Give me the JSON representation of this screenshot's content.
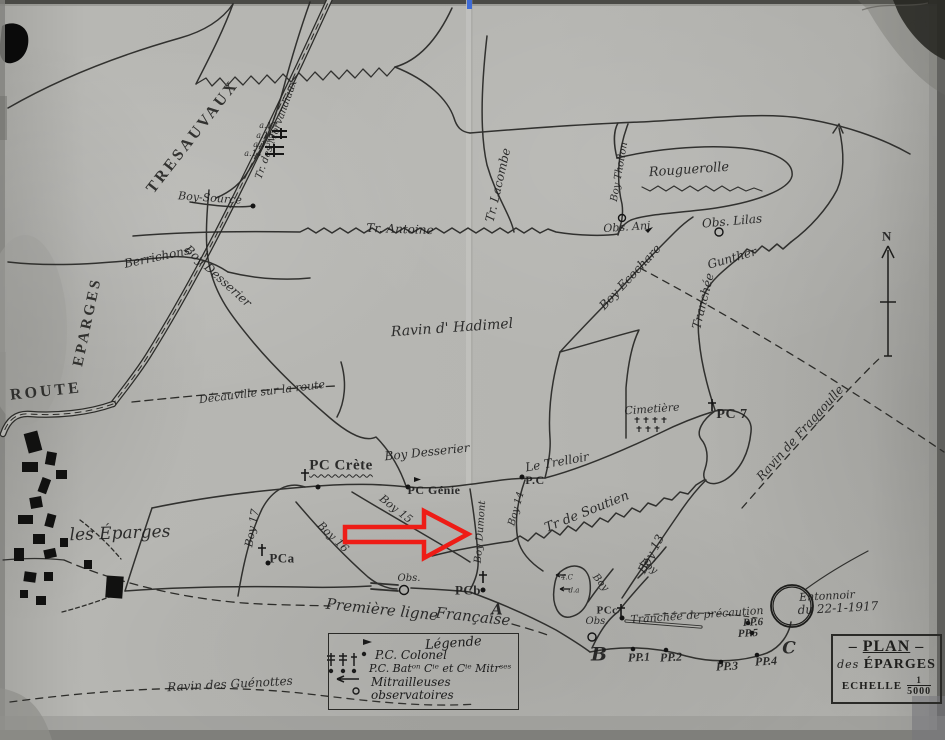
{
  "page": {
    "paper_color": "#b5b5b1",
    "ink_color": "#262624",
    "page_number": "27"
  },
  "annotation": {
    "type": "arrow",
    "color": "#ee1c16"
  },
  "north": {
    "label": "N"
  },
  "title_box": {
    "dash": "–",
    "line1": "PLAN",
    "prefix": "des",
    "line2": "ÉPARGES",
    "scale_label": "ECHELLE",
    "scale_num": "1",
    "scale_den": "5000"
  },
  "legend": {
    "title": "Légende",
    "items": [
      {
        "symbol": "flag-dot",
        "label": "P.C. Colonel"
      },
      {
        "symbol": "cross-dots",
        "label": "P.C. Batᵒⁿ Cⁱᵉ et Cⁱᵉ Mitrˢᵉˢ"
      },
      {
        "symbol": "arrow-left",
        "label": "Mitrailleuses"
      },
      {
        "symbol": "small-circle",
        "label": "observatoires"
      }
    ]
  },
  "crater": {
    "line1": "Entonnoir",
    "line2": "du 22-1-1917"
  },
  "map_labels": [
    {
      "t": "TRESAUVAUX",
      "x": 193,
      "y": 137,
      "r": -52,
      "s": 16,
      "c": "caps",
      "n": "label-tresauvaux"
    },
    {
      "t": "EPARGES",
      "x": 88,
      "y": 322,
      "r": -78,
      "s": 15,
      "c": "caps",
      "n": "label-eparges-road"
    },
    {
      "t": "ROUTE",
      "x": 46,
      "y": 392,
      "r": -6,
      "s": 16,
      "c": "caps",
      "n": "label-route"
    },
    {
      "t": "Berrichons",
      "x": 157,
      "y": 257,
      "r": -12,
      "s": 12,
      "n": "label-berrichons"
    },
    {
      "t": "Boy Desserier",
      "x": 218,
      "y": 276,
      "r": 42,
      "s": 12,
      "n": "label-boy-desserier-nw"
    },
    {
      "t": "Boy-Source",
      "x": 210,
      "y": 198,
      "r": 4,
      "s": 11,
      "n": "label-boy-source"
    },
    {
      "t": "Tr. des Morvandiaux",
      "x": 277,
      "y": 130,
      "r": -70,
      "s": 10,
      "n": "label-tr-morvandiaux"
    },
    {
      "t": "a.17",
      "x": 268,
      "y": 126,
      "r": 0,
      "s": 8,
      "n": "label-a17"
    },
    {
      "t": "a.16",
      "x": 265,
      "y": 136,
      "r": 0,
      "s": 8,
      "n": "label-a16"
    },
    {
      "t": "a.15",
      "x": 262,
      "y": 145,
      "r": 0,
      "s": 8,
      "n": "label-a15"
    },
    {
      "t": "a.14",
      "x": 253,
      "y": 154,
      "r": 0,
      "s": 8,
      "n": "label-a14"
    },
    {
      "t": "Tr. Antoine",
      "x": 400,
      "y": 229,
      "r": 2,
      "s": 12,
      "n": "label-tr-antoine"
    },
    {
      "t": "Tr. Lacombe",
      "x": 498,
      "y": 185,
      "r": -77,
      "s": 12,
      "n": "label-tr-lacombe"
    },
    {
      "t": "Boy Thollon",
      "x": 620,
      "y": 172,
      "r": -80,
      "s": 10,
      "n": "label-boy-thollon"
    },
    {
      "t": "Rouguerolle",
      "x": 689,
      "y": 170,
      "r": -4,
      "s": 13,
      "n": "label-rouguerolle"
    },
    {
      "t": "Obs. Ani",
      "x": 627,
      "y": 227,
      "r": -4,
      "s": 11,
      "n": "label-obs-ani"
    },
    {
      "t": "Obs. Lilas",
      "x": 732,
      "y": 221,
      "r": -5,
      "s": 12,
      "n": "label-obs-lilas"
    },
    {
      "t": "Boy Ecochare",
      "x": 630,
      "y": 277,
      "r": -47,
      "s": 12,
      "n": "label-boy-ecochare"
    },
    {
      "t": "Gunther",
      "x": 732,
      "y": 258,
      "r": -16,
      "s": 12,
      "n": "label-gunther"
    },
    {
      "t": "Tranchée",
      "x": 703,
      "y": 301,
      "r": -76,
      "s": 12,
      "n": "label-tranchee-gunther"
    },
    {
      "t": "Ravin   d' Hadimel",
      "x": 452,
      "y": 328,
      "r": -4,
      "s": 14,
      "n": "label-ravin-hadimel"
    },
    {
      "t": "Décauville sur la route",
      "x": 262,
      "y": 392,
      "r": -7,
      "s": 11,
      "n": "label-decauville"
    },
    {
      "t": "Cimetière",
      "x": 652,
      "y": 409,
      "r": -4,
      "s": 11,
      "n": "label-cimetiere"
    },
    {
      "t": "PC 7",
      "x": 732,
      "y": 415,
      "r": 0,
      "s": 14,
      "c": "print",
      "n": "label-pc7"
    },
    {
      "t": "Ravin de Fragaoulle",
      "x": 800,
      "y": 433,
      "r": -48,
      "s": 12,
      "n": "label-ravin-fragaoulle"
    },
    {
      "t": "PC Crète",
      "x": 341,
      "y": 466,
      "r": 0,
      "s": 15,
      "c": "print u-wavy",
      "n": "label-pc-crete"
    },
    {
      "t": "Boy Desserier",
      "x": 427,
      "y": 452,
      "r": -6,
      "s": 12,
      "n": "label-boy-desserier-center"
    },
    {
      "t": "PC Génie",
      "x": 434,
      "y": 490,
      "r": 0,
      "s": 12,
      "c": "print",
      "n": "label-pc-genie"
    },
    {
      "t": "Le Trelloir",
      "x": 557,
      "y": 462,
      "r": -10,
      "s": 12,
      "n": "label-le-trelloir"
    },
    {
      "t": "P.C",
      "x": 535,
      "y": 480,
      "r": 0,
      "s": 12,
      "c": "print",
      "n": "label-pc"
    },
    {
      "t": "Boy 14",
      "x": 517,
      "y": 509,
      "r": -74,
      "s": 10,
      "n": "label-boy14"
    },
    {
      "t": "Tr de Soutien",
      "x": 587,
      "y": 512,
      "r": -22,
      "s": 13,
      "n": "label-tr-soutien"
    },
    {
      "t": "Boy 13",
      "x": 651,
      "y": 554,
      "r": -62,
      "s": 12,
      "n": "label-boy13"
    },
    {
      "t": "Boy 17",
      "x": 252,
      "y": 528,
      "r": -80,
      "s": 11,
      "n": "label-boy17"
    },
    {
      "t": "Boy 15",
      "x": 396,
      "y": 509,
      "r": 38,
      "s": 11,
      "n": "label-boy15"
    },
    {
      "t": "Boy 16",
      "x": 333,
      "y": 537,
      "r": 44,
      "s": 11,
      "n": "label-boy16"
    },
    {
      "t": "Boy Dumont",
      "x": 481,
      "y": 532,
      "r": -86,
      "s": 10,
      "n": "label-boy-dumont"
    },
    {
      "t": "PCa",
      "x": 282,
      "y": 558,
      "r": 0,
      "s": 13,
      "c": "print",
      "n": "label-pca"
    },
    {
      "t": "Obs.",
      "x": 409,
      "y": 579,
      "r": 0,
      "s": 10,
      "n": "label-obs-center"
    },
    {
      "t": "PCb",
      "x": 468,
      "y": 590,
      "r": 0,
      "s": 13,
      "c": "print",
      "n": "label-pcb"
    },
    {
      "t": "Première ligne",
      "x": 382,
      "y": 610,
      "r": 6,
      "s": 15,
      "n": "label-premiere-ligne"
    },
    {
      "t": "Française",
      "x": 473,
      "y": 617,
      "r": 6,
      "s": 15,
      "n": "label-francaise"
    },
    {
      "t": "A",
      "x": 497,
      "y": 610,
      "r": 0,
      "s": 15,
      "c": "serifbold",
      "n": "label-point-a"
    },
    {
      "t": "B",
      "x": 599,
      "y": 655,
      "r": 0,
      "s": 19,
      "c": "serifbold",
      "n": "label-point-b"
    },
    {
      "t": "C",
      "x": 789,
      "y": 649,
      "r": 0,
      "s": 17,
      "c": "serifbold",
      "n": "label-point-c"
    },
    {
      "t": "PP.1",
      "x": 639,
      "y": 657,
      "r": -3,
      "s": 12,
      "c": "printbold",
      "n": "label-pp1"
    },
    {
      "t": "PP.2",
      "x": 671,
      "y": 657,
      "r": -3,
      "s": 12,
      "c": "printbold",
      "n": "label-pp2"
    },
    {
      "t": "PP.3",
      "x": 727,
      "y": 666,
      "r": -3,
      "s": 12,
      "c": "printbold",
      "n": "label-pp3"
    },
    {
      "t": "PP.4",
      "x": 766,
      "y": 661,
      "r": -3,
      "s": 12,
      "c": "printbold",
      "n": "label-pp4"
    },
    {
      "t": "PP.5",
      "x": 748,
      "y": 634,
      "r": -3,
      "s": 11,
      "c": "printbold",
      "n": "label-pp5"
    },
    {
      "t": "PP.6",
      "x": 753,
      "y": 623,
      "r": -3,
      "s": 11,
      "c": "printbold",
      "n": "label-pp6"
    },
    {
      "t": "Tranchée de précaution",
      "x": 697,
      "y": 615,
      "r": -4,
      "s": 11,
      "n": "label-tranchee-precaution"
    },
    {
      "t": "PCc",
      "x": 607,
      "y": 611,
      "r": 0,
      "s": 11,
      "c": "print",
      "n": "label-pcc"
    },
    {
      "t": "Obs.",
      "x": 597,
      "y": 622,
      "r": 0,
      "s": 10,
      "n": "label-obs-b"
    },
    {
      "t": "Boy",
      "x": 600,
      "y": 583,
      "r": 50,
      "s": 10,
      "n": "label-boy-b1"
    },
    {
      "t": "Boy",
      "x": 648,
      "y": 567,
      "r": 35,
      "s": 10,
      "n": "label-boy-b2"
    },
    {
      "t": "4.C",
      "x": 567,
      "y": 578,
      "r": 0,
      "s": 7,
      "n": "label-4c"
    },
    {
      "t": "d.a",
      "x": 574,
      "y": 591,
      "r": 0,
      "s": 7,
      "n": "label-da"
    },
    {
      "t": "les Éparges",
      "x": 120,
      "y": 534,
      "r": -2,
      "s": 17,
      "n": "label-les-eparges"
    },
    {
      "t": "Ravin des Guénottes",
      "x": 230,
      "y": 684,
      "r": -3,
      "s": 12,
      "n": "label-ravin-guenottes"
    },
    {
      "t": "Entonnoir",
      "x": 827,
      "y": 596,
      "r": -3,
      "s": 11,
      "n": "label-entonnoir-1"
    },
    {
      "t": "du 22-1-1917",
      "x": 838,
      "y": 608,
      "r": -3,
      "s": 12,
      "n": "label-entonnoir-2"
    },
    {
      "t": "N",
      "x": 887,
      "y": 236,
      "r": 0,
      "s": 13,
      "c": "print",
      "n": "label-north-n"
    },
    {
      "t": "27",
      "x": 921,
      "y": 25,
      "r": -38,
      "s": 17,
      "c": "hand",
      "n": "label-page-number"
    }
  ]
}
